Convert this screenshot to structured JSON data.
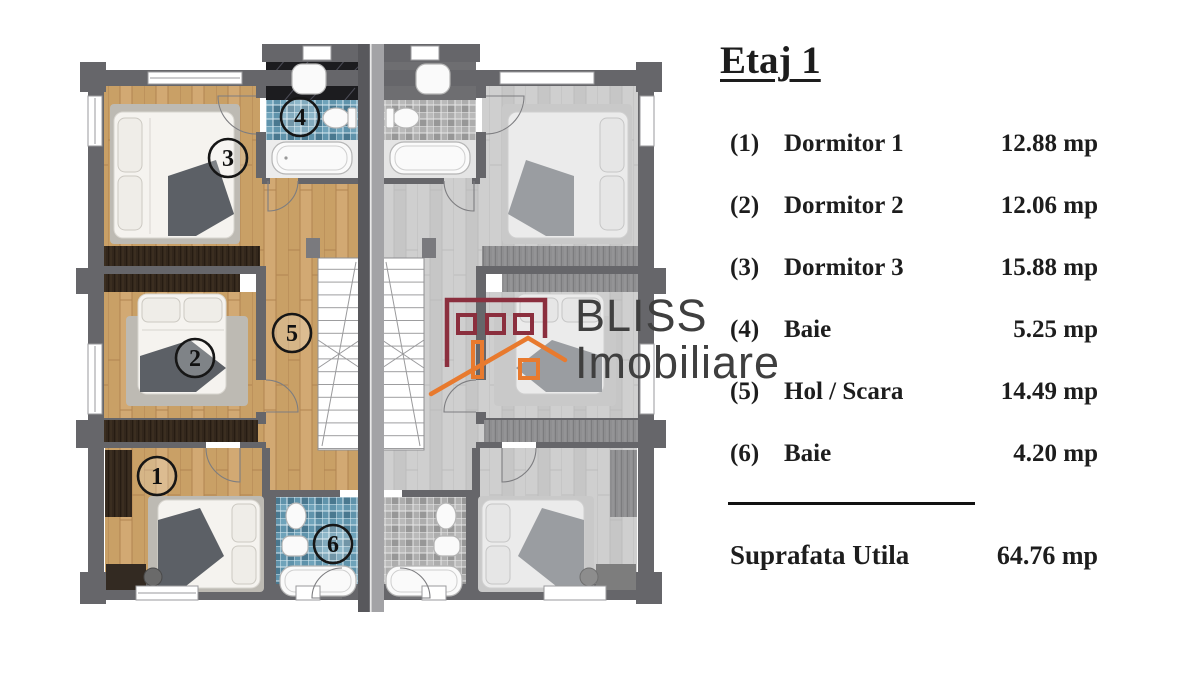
{
  "title": "Etaj 1",
  "plan": {
    "markers": [
      "1",
      "2",
      "3",
      "4",
      "5",
      "6"
    ]
  },
  "legend": {
    "rows": [
      {
        "num": "(1)",
        "name": "Dormitor 1",
        "area": "12.88 mp"
      },
      {
        "num": "(2)",
        "name": "Dormitor 2",
        "area": "12.06 mp"
      },
      {
        "num": "(3)",
        "name": "Dormitor 3",
        "area": "15.88 mp"
      },
      {
        "num": "(4)",
        "name": "Baie",
        "area": "5.25 mp"
      },
      {
        "num": "(5)",
        "name": "Hol / Scara",
        "area": "14.49 mp"
      },
      {
        "num": "(6)",
        "name": "Baie",
        "area": "4.20 mp"
      }
    ],
    "total_label": "Suprafata Utila",
    "total_area": "64.76 mp"
  },
  "watermark": {
    "brand_line1": "BLISS",
    "brand_line2": "Imobiliare"
  },
  "colors": {
    "wood": "#c9a066",
    "wall": "#66666a",
    "tile_blue": "#5f93ab",
    "brand_maroon": "#8b2f3e",
    "brand_orange": "#e87a2e"
  }
}
